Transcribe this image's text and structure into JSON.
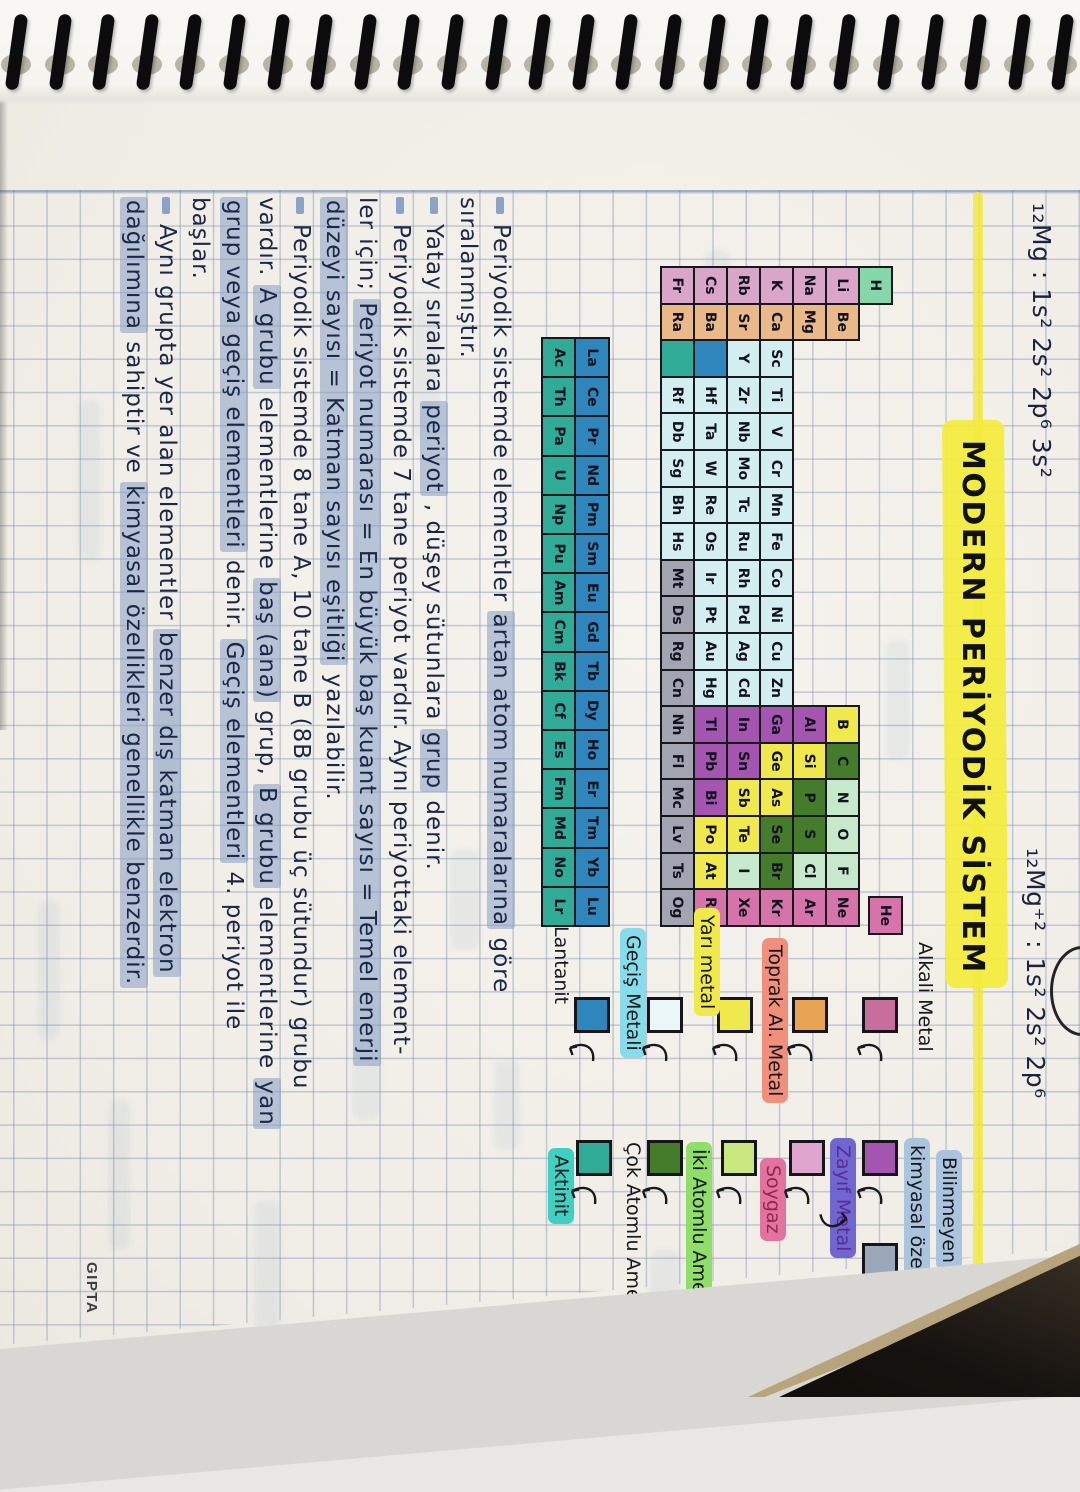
{
  "notebook": {
    "brand": "GIPTA"
  },
  "header": {
    "config_left": "₁₂Mg : 1s² 2s² 2p⁶ 3s²",
    "config_right": "₁₂Mg⁺² : 1s² 2s² 2p⁶",
    "title": "MODERN PERİYODİK SİSTEM",
    "title_highlight_color": "#f4eb3a"
  },
  "periodic_table": {
    "periods": [
      [
        "H",
        "He"
      ],
      [
        "Li",
        "Be",
        "B",
        "C",
        "N",
        "O",
        "F",
        "Ne"
      ],
      [
        "Na",
        "Mg",
        "Al",
        "Si",
        "P",
        "S",
        "Cl",
        "Ar"
      ],
      [
        "K",
        "Ca",
        "Sc",
        "Ti",
        "V",
        "Cr",
        "Mn",
        "Fe",
        "Co",
        "Ni",
        "Cu",
        "Zn",
        "Ga",
        "Ge",
        "As",
        "Se",
        "Br",
        "Kr"
      ],
      [
        "Rb",
        "Sr",
        "Y",
        "Zr",
        "Nb",
        "Mo",
        "Tc",
        "Ru",
        "Rh",
        "Pd",
        "Ag",
        "Cd",
        "In",
        "Sn",
        "Sb",
        "Te",
        "I",
        "Xe"
      ],
      [
        "Cs",
        "Ba",
        "*",
        "Hf",
        "Ta",
        "W",
        "Re",
        "Os",
        "Ir",
        "Pt",
        "Au",
        "Hg",
        "Tl",
        "Pb",
        "Bi",
        "Po",
        "At",
        "Rn"
      ],
      [
        "Fr",
        "Ra",
        "**",
        "Rf",
        "Db",
        "Sg",
        "Bh",
        "Hs",
        "Mt",
        "Ds",
        "Rg",
        "Cn",
        "Nh",
        "Fl",
        "Mc",
        "Lv",
        "Ts",
        "Og"
      ]
    ],
    "lanthanides": [
      "La",
      "Ce",
      "Pr",
      "Nd",
      "Pm",
      "Sm",
      "Eu",
      "Gd",
      "Tb",
      "Dy",
      "Ho",
      "Er",
      "Tm",
      "Yb",
      "Lu"
    ],
    "actinides": [
      "Ac",
      "Th",
      "Pa",
      "U",
      "Np",
      "Pu",
      "Am",
      "Cm",
      "Bk",
      "Cf",
      "Es",
      "Fm",
      "Md",
      "No",
      "Lr"
    ],
    "category_colors": {
      "hydrogen": "#85d7a9",
      "alkali": "#d9a6c9",
      "alkaline_earth": "#eab98a",
      "transition": "#d3eef1",
      "post_transition": "#a455b0",
      "metalloid": "#efe94e",
      "polyatomic_nonmetal": "#447c2c",
      "diatomic_nonmetal": "#c6e9cb",
      "noble_gas": "#d673ab",
      "lanthanide": "#2f86bd",
      "actinide": "#2fab97",
      "unknown": "#a3a4b2"
    },
    "categories": {
      "hydrogen": [
        "H"
      ],
      "alkali": [
        "Li",
        "Na",
        "K",
        "Rb",
        "Cs",
        "Fr"
      ],
      "alkaline_earth": [
        "Be",
        "Mg",
        "Ca",
        "Sr",
        "Ba",
        "Ra"
      ],
      "transition": [
        "Sc",
        "Ti",
        "V",
        "Cr",
        "Mn",
        "Fe",
        "Co",
        "Ni",
        "Cu",
        "Zn",
        "Y",
        "Zr",
        "Nb",
        "Mo",
        "Tc",
        "Ru",
        "Rh",
        "Pd",
        "Ag",
        "Cd",
        "Hf",
        "Ta",
        "W",
        "Re",
        "Os",
        "Ir",
        "Pt",
        "Au",
        "Hg",
        "Rf",
        "Db",
        "Sg",
        "Bh",
        "Hs"
      ],
      "unknown": [
        "Mt",
        "Ds",
        "Rg",
        "Cn",
        "Nh",
        "Fl",
        "Mc",
        "Lv",
        "Ts",
        "Og"
      ],
      "post_transition": [
        "Al",
        "Ga",
        "In",
        "Sn",
        "Tl",
        "Pb",
        "Bi"
      ],
      "metalloid": [
        "B",
        "Si",
        "Ge",
        "As",
        "Sb",
        "Te",
        "Po",
        "At"
      ],
      "polyatomic_nonmetal": [
        "C",
        "P",
        "S",
        "Se",
        "Br"
      ],
      "diatomic_nonmetal": [
        "N",
        "O",
        "F",
        "Cl",
        "I"
      ],
      "noble_gas": [
        "He",
        "Ne",
        "Ar",
        "Kr",
        "Xe",
        "Rn"
      ],
      "lanthanide": [
        "La",
        "Ce",
        "Pr",
        "Nd",
        "Pm",
        "Sm",
        "Eu",
        "Gd",
        "Tb",
        "Dy",
        "Ho",
        "Er",
        "Tm",
        "Yb",
        "Lu"
      ],
      "actinide": [
        "Ac",
        "Th",
        "Pa",
        "U",
        "Np",
        "Pu",
        "Am",
        "Cm",
        "Bk",
        "Cf",
        "Es",
        "Fm",
        "Md",
        "No",
        "Lr"
      ]
    }
  },
  "legend": {
    "column1": [
      {
        "label": "Alkali Metal",
        "band": null,
        "ink": "#15181c",
        "box": "#c76e9d"
      },
      {
        "label": "Toprak Al. Metal",
        "band": "#ef8f7c",
        "ink": "#15181c",
        "box": "#e8a355"
      },
      {
        "label": "Yarı metal",
        "band": "#f0e94a",
        "ink": "#15181c",
        "box": "#efe94e"
      },
      {
        "label": "Geçiş Metali",
        "band": "#87dce9",
        "ink": "#15181c",
        "box": "#eaf6f7"
      },
      {
        "label": "Lantanit",
        "band": null,
        "ink": "#15181c",
        "box": "#2f86bd"
      }
    ],
    "column2": [
      {
        "label": "Zayıf Metal",
        "band": "#6f66d0",
        "ink": "#5c2a96",
        "box": "#a455b0"
      },
      {
        "label": "Soygaz",
        "band": "#e2739f",
        "ink": "#92274e",
        "box": "#e0a5cf"
      },
      {
        "label": "İki Atomlu Ametal",
        "band": "#8ede68",
        "ink": "#15181c",
        "box": "#cbe77f"
      },
      {
        "label": "Çok Atomlu Ametal",
        "band": null,
        "ink": "#15181c",
        "box": "#447c2c"
      },
      {
        "label": "Aktinit",
        "band": "#3fd0c2",
        "ink": "#15181c",
        "box": "#2fab97"
      }
    ],
    "unknown_item": {
      "label_line1": "Bilinmeyen",
      "label_line2": "kimyasal özellikler",
      "band": "#aac4de",
      "ink": "#15181c",
      "box": "#9aa7b8"
    }
  },
  "notes": {
    "highlight_color": "#869ec5",
    "lines": [
      {
        "bullet": true,
        "segments": [
          {
            "t": "Periyodik sistemde elementler ",
            "h": false
          },
          {
            "t": "artan atom numaralarına",
            "h": true
          },
          {
            "t": " göre",
            "h": false
          }
        ]
      },
      {
        "bullet": false,
        "segments": [
          {
            "t": "sıralanmıştır.",
            "h": false
          }
        ]
      },
      {
        "bullet": true,
        "segments": [
          {
            "t": "Yatay sıralara ",
            "h": false
          },
          {
            "t": "periyot",
            "h": true
          },
          {
            "t": " , düşey sütunlara ",
            "h": false
          },
          {
            "t": "grup",
            "h": true
          },
          {
            "t": " denir.",
            "h": false
          }
        ]
      },
      {
        "bullet": true,
        "segments": [
          {
            "t": "Periyodik sistemde 7 tane periyot vardır. Aynı periyottaki element-",
            "h": false
          }
        ]
      },
      {
        "bullet": false,
        "segments": [
          {
            "t": "ler için; ",
            "h": false
          },
          {
            "t": "Periyot numarası = En büyük baş kuant sayısı = Temel enerji",
            "h": true
          }
        ]
      },
      {
        "bullet": false,
        "segments": [
          {
            "t": "düzeyi sayısı = Katman sayısı eşitliği",
            "h": true
          },
          {
            "t": " yazılabilir.",
            "h": false
          }
        ]
      },
      {
        "bullet": true,
        "segments": [
          {
            "t": "Periyodik sistemde 8 tane A, 10 tane B (8B grubu üç sütundur) grubu",
            "h": false
          }
        ]
      },
      {
        "bullet": false,
        "segments": [
          {
            "t": "vardır. ",
            "h": false
          },
          {
            "t": "A grubu",
            "h": true
          },
          {
            "t": " elementlerine ",
            "h": false
          },
          {
            "t": "baş (ana)",
            "h": true
          },
          {
            "t": " grup, ",
            "h": false
          },
          {
            "t": "B grubu",
            "h": true
          },
          {
            "t": " elementlerine ",
            "h": false
          },
          {
            "t": "yan",
            "h": true
          }
        ]
      },
      {
        "bullet": false,
        "segments": [
          {
            "t": "grup veya geçiş elementleri",
            "h": true
          },
          {
            "t": " denir. ",
            "h": false
          },
          {
            "t": "Geçiş elementleri",
            "h": true
          },
          {
            "t": " 4. periyot ile",
            "h": false
          }
        ]
      },
      {
        "bullet": false,
        "segments": [
          {
            "t": "başlar.",
            "h": false
          }
        ]
      },
      {
        "bullet": true,
        "segments": [
          {
            "t": "Aynı grupta yer alan elementler ",
            "h": false
          },
          {
            "t": "benzer dış katman elektron",
            "h": true
          }
        ]
      },
      {
        "bullet": false,
        "segments": [
          {
            "t": "dağılımına",
            "h": true
          },
          {
            "t": " sahiptir ve ",
            "h": false
          },
          {
            "t": "kimyasal özellikleri genellikle benzerdir.",
            "h": true
          }
        ]
      }
    ]
  }
}
